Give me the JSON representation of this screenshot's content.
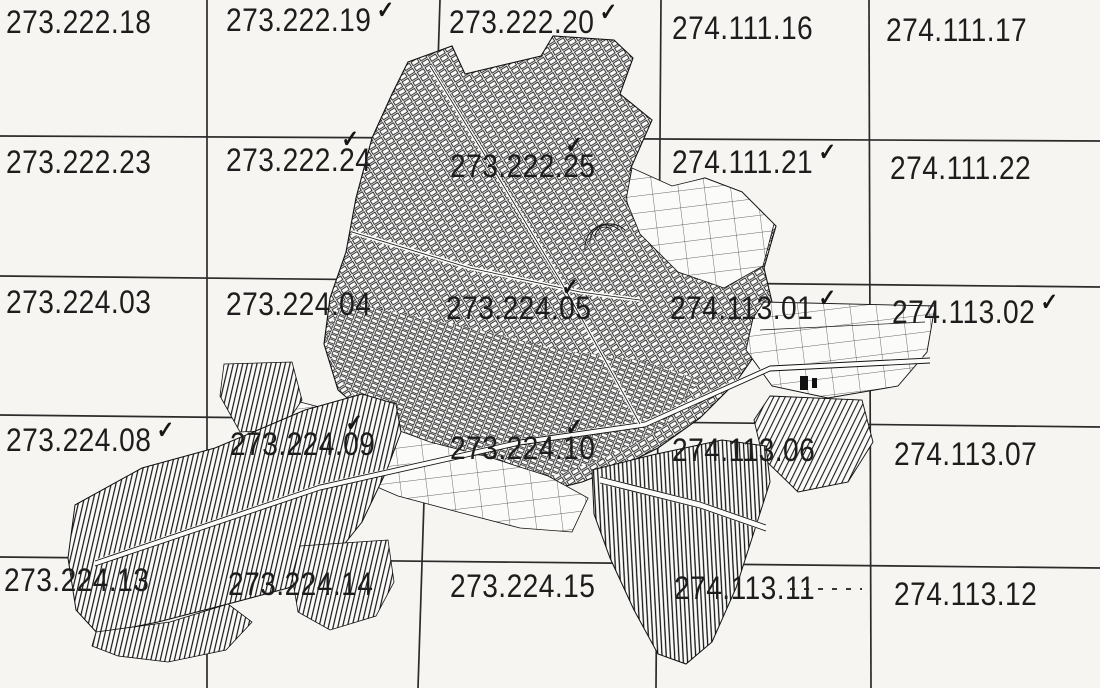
{
  "grid": {
    "cells": [
      {
        "label": "273.222.18",
        "check": ""
      },
      {
        "label": "273.222.19",
        "check": "✓"
      },
      {
        "label": "273.222.20",
        "check": "✓"
      },
      {
        "label": "274.111.16",
        "check": ""
      },
      {
        "label": "274.111.17",
        "check": ""
      },
      {
        "label": "273.222.23",
        "check": ""
      },
      {
        "label": "273.222.24",
        "check": "✓"
      },
      {
        "label": "273.222.25",
        "check": "✓"
      },
      {
        "label": "274.111.21",
        "check": "✓"
      },
      {
        "label": "274.111.22",
        "check": ""
      },
      {
        "label": "273.224.03",
        "check": ""
      },
      {
        "label": "273.224.04",
        "check": ""
      },
      {
        "label": "273.224.05",
        "check": "✓"
      },
      {
        "label": "274.113.01",
        "check": "✓"
      },
      {
        "label": "274.113.02",
        "check": "✓"
      },
      {
        "label": "273.224.08",
        "check": "✓"
      },
      {
        "label": "273.224.09",
        "check": "✓"
      },
      {
        "label": "273.224.10",
        "check": "✓"
      },
      {
        "label": "274.113.06",
        "check": ""
      },
      {
        "label": "274.113.07",
        "check": ""
      },
      {
        "label": "273.224.13",
        "check": ""
      },
      {
        "label": "273.224.14",
        "check": ""
      },
      {
        "label": "273.224.15",
        "check": ""
      },
      {
        "label": "274.113.11",
        "check": ""
      },
      {
        "label": "274.113.12",
        "check": ""
      }
    ]
  },
  "icons": {
    "checkmark": "✓"
  },
  "colors": {
    "ink": "#1d1d1d",
    "paper": "#f6f5f2",
    "grid_line": "#2b2b2b"
  }
}
